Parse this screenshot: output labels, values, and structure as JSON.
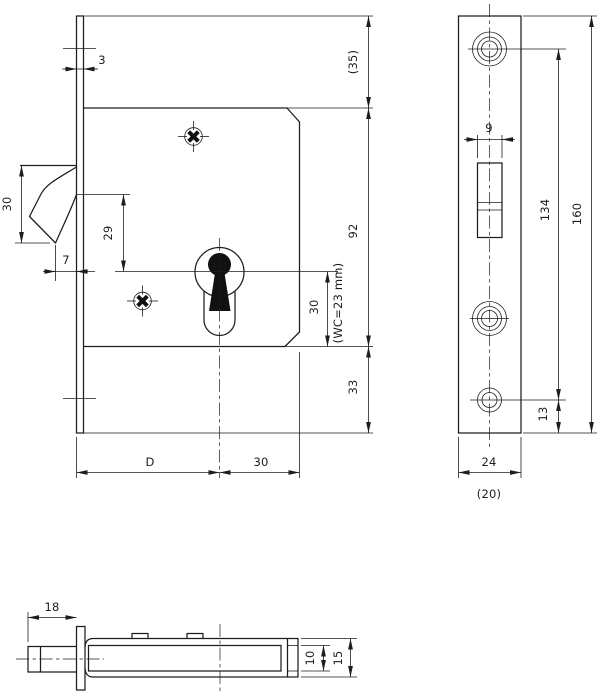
{
  "drawing": {
    "background": "#ffffff",
    "line_color": "#1d1d1d",
    "views": {
      "front_view": {
        "name": "lock case front view",
        "dims": {
          "faceplate_thickness": "3",
          "hook_bolt_height": "30",
          "hook_to_key_center": "29",
          "hook_protrusion": "7",
          "top_to_case": "(35)",
          "case_height": "92",
          "key_center_to_case_bottom": "30",
          "wc_note": "(WC=23 mm)",
          "case_bottom_to_plate_end": "33",
          "backset": "D",
          "key_center_to_case_edge": "30"
        }
      },
      "faceplate_view": {
        "name": "faceplate front view",
        "dims": {
          "bolt_slot_width": "9",
          "screw_hole_spacing": "134",
          "faceplate_height": "160",
          "lower_hole_to_end": "13",
          "faceplate_width": "24",
          "case_width": "(20)"
        }
      },
      "bottom_view": {
        "name": "bottom view",
        "dims": {
          "bolt_projection": "18",
          "case_thickness": "10",
          "overall_thickness": "15"
        }
      }
    }
  }
}
